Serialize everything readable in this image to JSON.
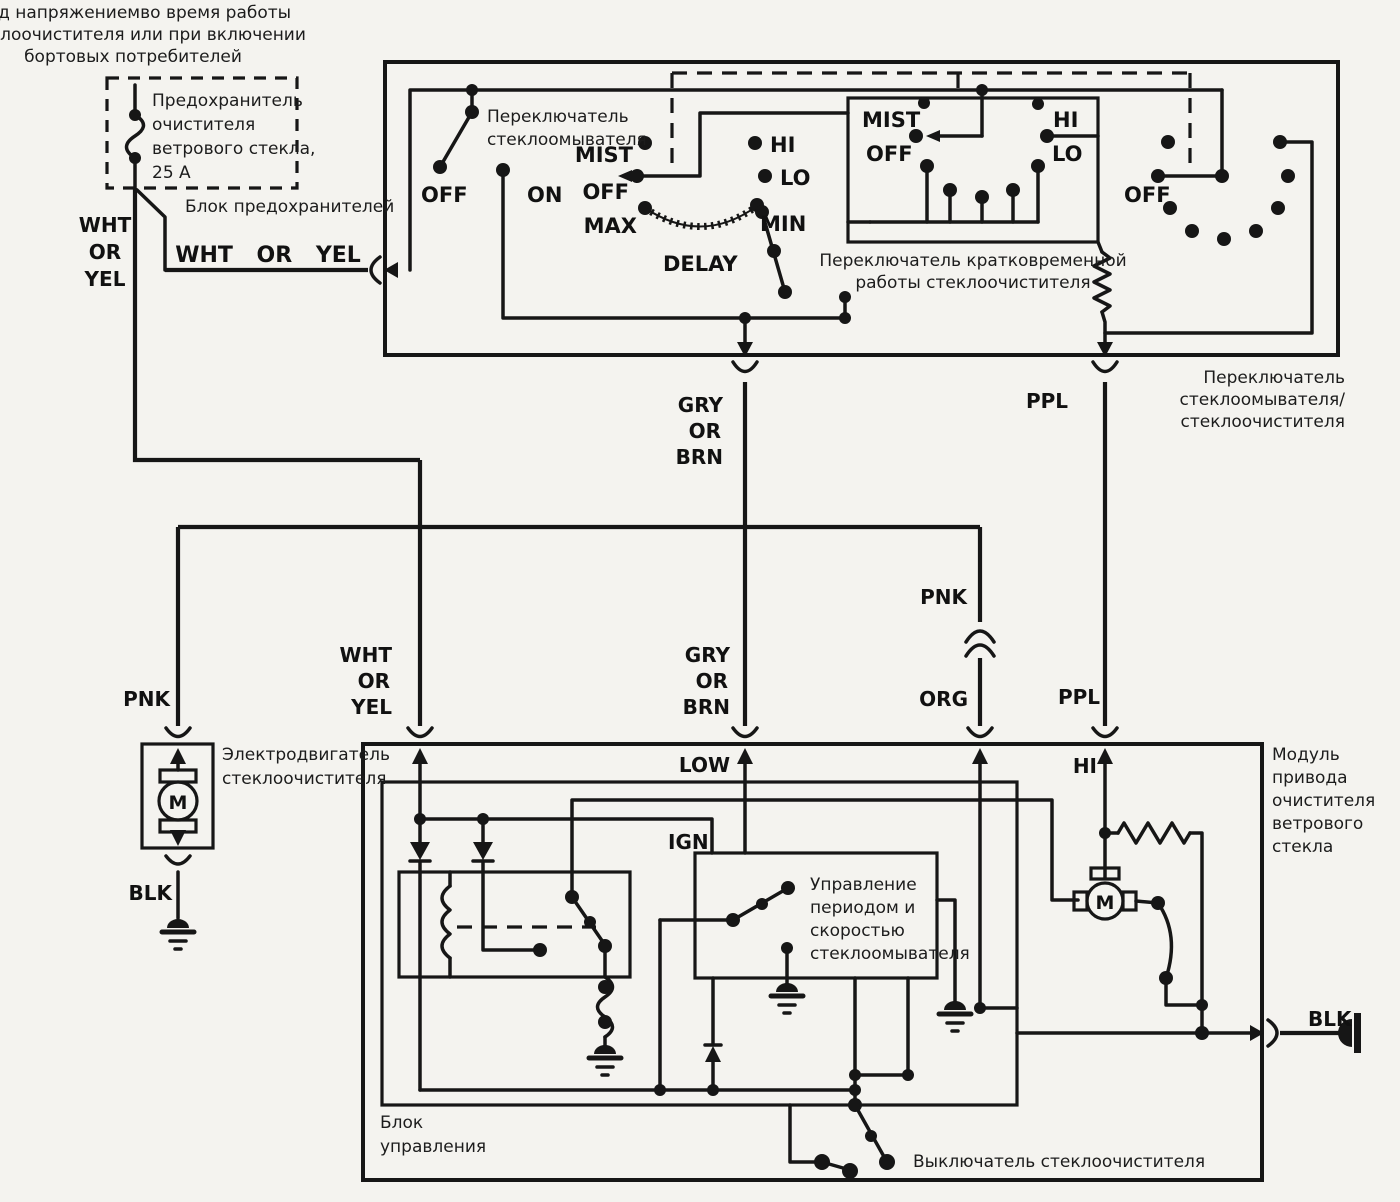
{
  "note_top_left": [
    "Под напряжениемво время работы",
    "стеклоочистителя или при включении",
    "бортовых потребителей"
  ],
  "fuse": {
    "label_lines": [
      "Предохранитель",
      "очистителя",
      "ветрового стекла,",
      "25 А"
    ]
  },
  "fuse_box_label": "Блок предохранителей",
  "combo_switch_label": [
    "Переключатель",
    "стеклоомывателя/",
    "стеклоочистителя"
  ],
  "washer_switch_label": [
    "Переключатель",
    "стеклоомывателя"
  ],
  "mist_switch_label": [
    "Переключатель кратковременной",
    "работы стеклоочистителя"
  ],
  "wiper_motor_label": [
    "Электродвигатель",
    "стеклоочистителя"
  ],
  "module_label": [
    "Модуль",
    "привода",
    "очистителя",
    "ветрового",
    "стекла"
  ],
  "control_box_label": [
    "Блок",
    "управления"
  ],
  "washer_ctrl_label": [
    "Управление",
    "периодом и",
    "скоростью",
    "стеклоомывателя"
  ],
  "wiper_switch_label": "Выключатель стеклоочистителя",
  "motor_letter": "M",
  "wires": {
    "wht_or_yel_h": "WHT OR YEL",
    "wht_or_yel_v": [
      "WHT",
      "OR",
      "YEL"
    ],
    "gry_or_brn": [
      "GRY",
      "OR",
      "BRN"
    ],
    "ppl": "PPL",
    "pnk": "PNK",
    "org": "ORG",
    "blk": "BLK",
    "low": "LOW",
    "ign": "IGN",
    "hi": "HI"
  },
  "positions": {
    "off": "OFF",
    "on": "ON",
    "mist": "MIST",
    "max": "MAX",
    "min": "MIN",
    "delay": "DELAY",
    "hi": "HI",
    "lo": "LO"
  },
  "colors": {
    "ink": "#161616",
    "paper": "#f4f3ef"
  }
}
